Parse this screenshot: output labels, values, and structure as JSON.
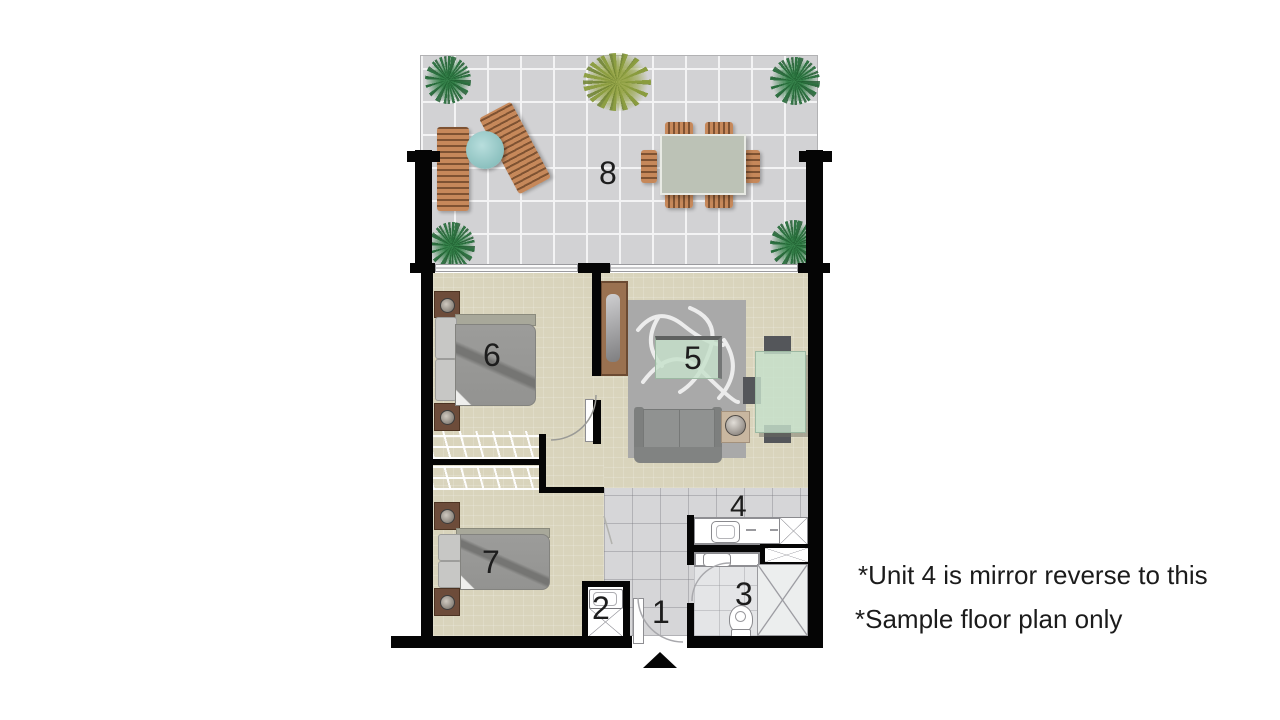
{
  "rooms": {
    "entry": "1",
    "laundry": "2",
    "bathroom": "3",
    "kitchen": "4",
    "living": "5",
    "bedroom_main": "6",
    "bedroom_second": "7",
    "terrace": "8"
  },
  "notes": {
    "line1": "*Unit 4 is mirror reverse to this",
    "line2": "*Sample floor plan only"
  },
  "colors": {
    "wall": "#050505",
    "floor_beige": "#d9d4bc",
    "terrace_tile": "#d2d2d4",
    "interior_tile": "#d6d6d8",
    "glass_green": "#c6e0cb",
    "wood_brown": "#9a7150",
    "plant_green": "#35824a",
    "text": "#1b1b1b"
  }
}
